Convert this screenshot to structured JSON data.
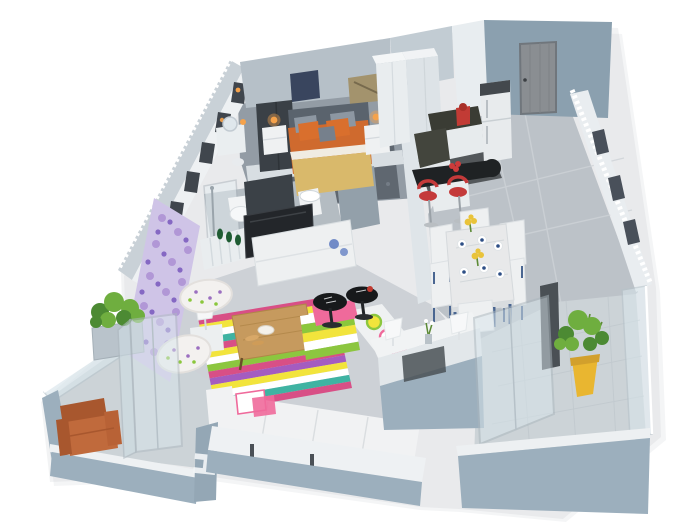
{
  "scene": {
    "title": "3D apartment floor plan render",
    "wall_mark": "H",
    "background": "#ffffff"
  },
  "palette": {
    "shadow_gray": "#b9bfc4",
    "wall_outer": "#9cafbd",
    "wall_face_light": "#b6c0c8",
    "wall_top_white": "#eef1f3",
    "wall_band": "#c9d1d7",
    "window_slot": "#40464d",
    "entry_wall": "#8ba0af",
    "entry_door": "#8a8e92",
    "right_wall_white": "#e9edf0",
    "mosaic_light": "#cfc4e7",
    "mosaic_mid": "#b197d6",
    "mosaic_dark": "#7e5fc0",
    "floor_hall": "#bcc2c8",
    "floor_living": "#cdd1d6",
    "floor_bedroom": "#939ca5",
    "bedroom_rug": "#5f6770",
    "floor_bath": "#b4bcc2",
    "floor_kitchen": "#54585b",
    "floor_balcony": "#ccd3d7",
    "glass": "#d9e6ec",
    "bed_headboard": "#5a636d",
    "bed_orange": "#cf6a2e",
    "bed_tan": "#d9b96b",
    "pillow_orange": "#d96f2d",
    "pillow_gray": "#8d97a2",
    "pillow_blue": "#76808c",
    "lamp_glow": "#f5a24b",
    "wardrobe_dark": "#3a4046",
    "art_blue": "#39455e",
    "art_gold": "#a3936d",
    "cabinet_white": "#e9edef",
    "counter_dark": "#3a3c34",
    "fridge_white": "#e8ebed",
    "mixer_red": "#c23b35",
    "bar_black": "#1f2224",
    "stool_red": "#c43a3a",
    "partition_dark": "#3b4147",
    "tv_black": "#23262a",
    "console_white": "#eef0f1",
    "vase_blue": "#5b79c0",
    "bottle_green": "#1f5c33",
    "sofa_white": "#f1f2f3",
    "rug_pink": "#d84f86",
    "rug_yellow": "#f2e43c",
    "rug_white": "#ffffff",
    "rug_teal": "#3fb3a2",
    "rug_green": "#8cc63f",
    "rug_purple": "#a45cc0",
    "pink_throw": "#ef6a9b",
    "wood": "#c69a5e",
    "side_table_black": "#17191b",
    "cup_red": "#c03a30",
    "print_purple": "#9b6fc0",
    "print_green": "#8bc73c",
    "marble_white": "#e8e9ea",
    "chair_white": "#eef0f1",
    "leg_blue": "#4a6691",
    "napkin_blue": "#2e4f86",
    "flower_yellow": "#e9c33a",
    "plant_green": "#6fae3f",
    "plant_dark": "#4c8a33",
    "pot_yellow": "#e9b630",
    "leather": "#c06a3c",
    "leather_dark": "#a8572e"
  },
  "rooms": [
    {
      "name": "bedroom",
      "items": [
        "double bed with orange bedding",
        "two white nightstands",
        "two glowing orange lamps",
        "dark wardrobe",
        "dressing table with round mirror",
        "wall art",
        "window wall"
      ]
    },
    {
      "name": "bathroom",
      "items": [
        "glass shower",
        "toilet",
        "washbasin",
        "white radiator with green bottles"
      ]
    },
    {
      "name": "kitchen",
      "items": [
        "tall white cabinets",
        "dark countertop",
        "red stand mixer",
        "fridge",
        "black breakfast bar",
        "two red bar stools"
      ]
    },
    {
      "name": "entry-hall",
      "items": [
        "gray front door",
        "gray marble tile floor"
      ]
    },
    {
      "name": "dining-area",
      "items": [
        "marble dining table",
        "white chairs with blue legs",
        "place settings with blue napkins",
        "yellow flower vases"
      ]
    },
    {
      "name": "living-room",
      "items": [
        "white corner sofa with colorful bolsters",
        "multicolor striped rug",
        "wooden coffee table",
        "black round side tables",
        "wall TV on media unit",
        "blue glass vases",
        "purple mosaic accent wall",
        "butterfly-print armchairs",
        "white table lamp",
        "half-wall console with two white lamps"
      ]
    },
    {
      "name": "balcony-left",
      "items": [
        "leather armchair",
        "planter box with green plant",
        "glass balustrade",
        "glass doors",
        "wall letter mark"
      ]
    },
    {
      "name": "balcony-right",
      "items": [
        "green plant in yellow pot",
        "glass railing",
        "small tiled floor"
      ]
    }
  ]
}
